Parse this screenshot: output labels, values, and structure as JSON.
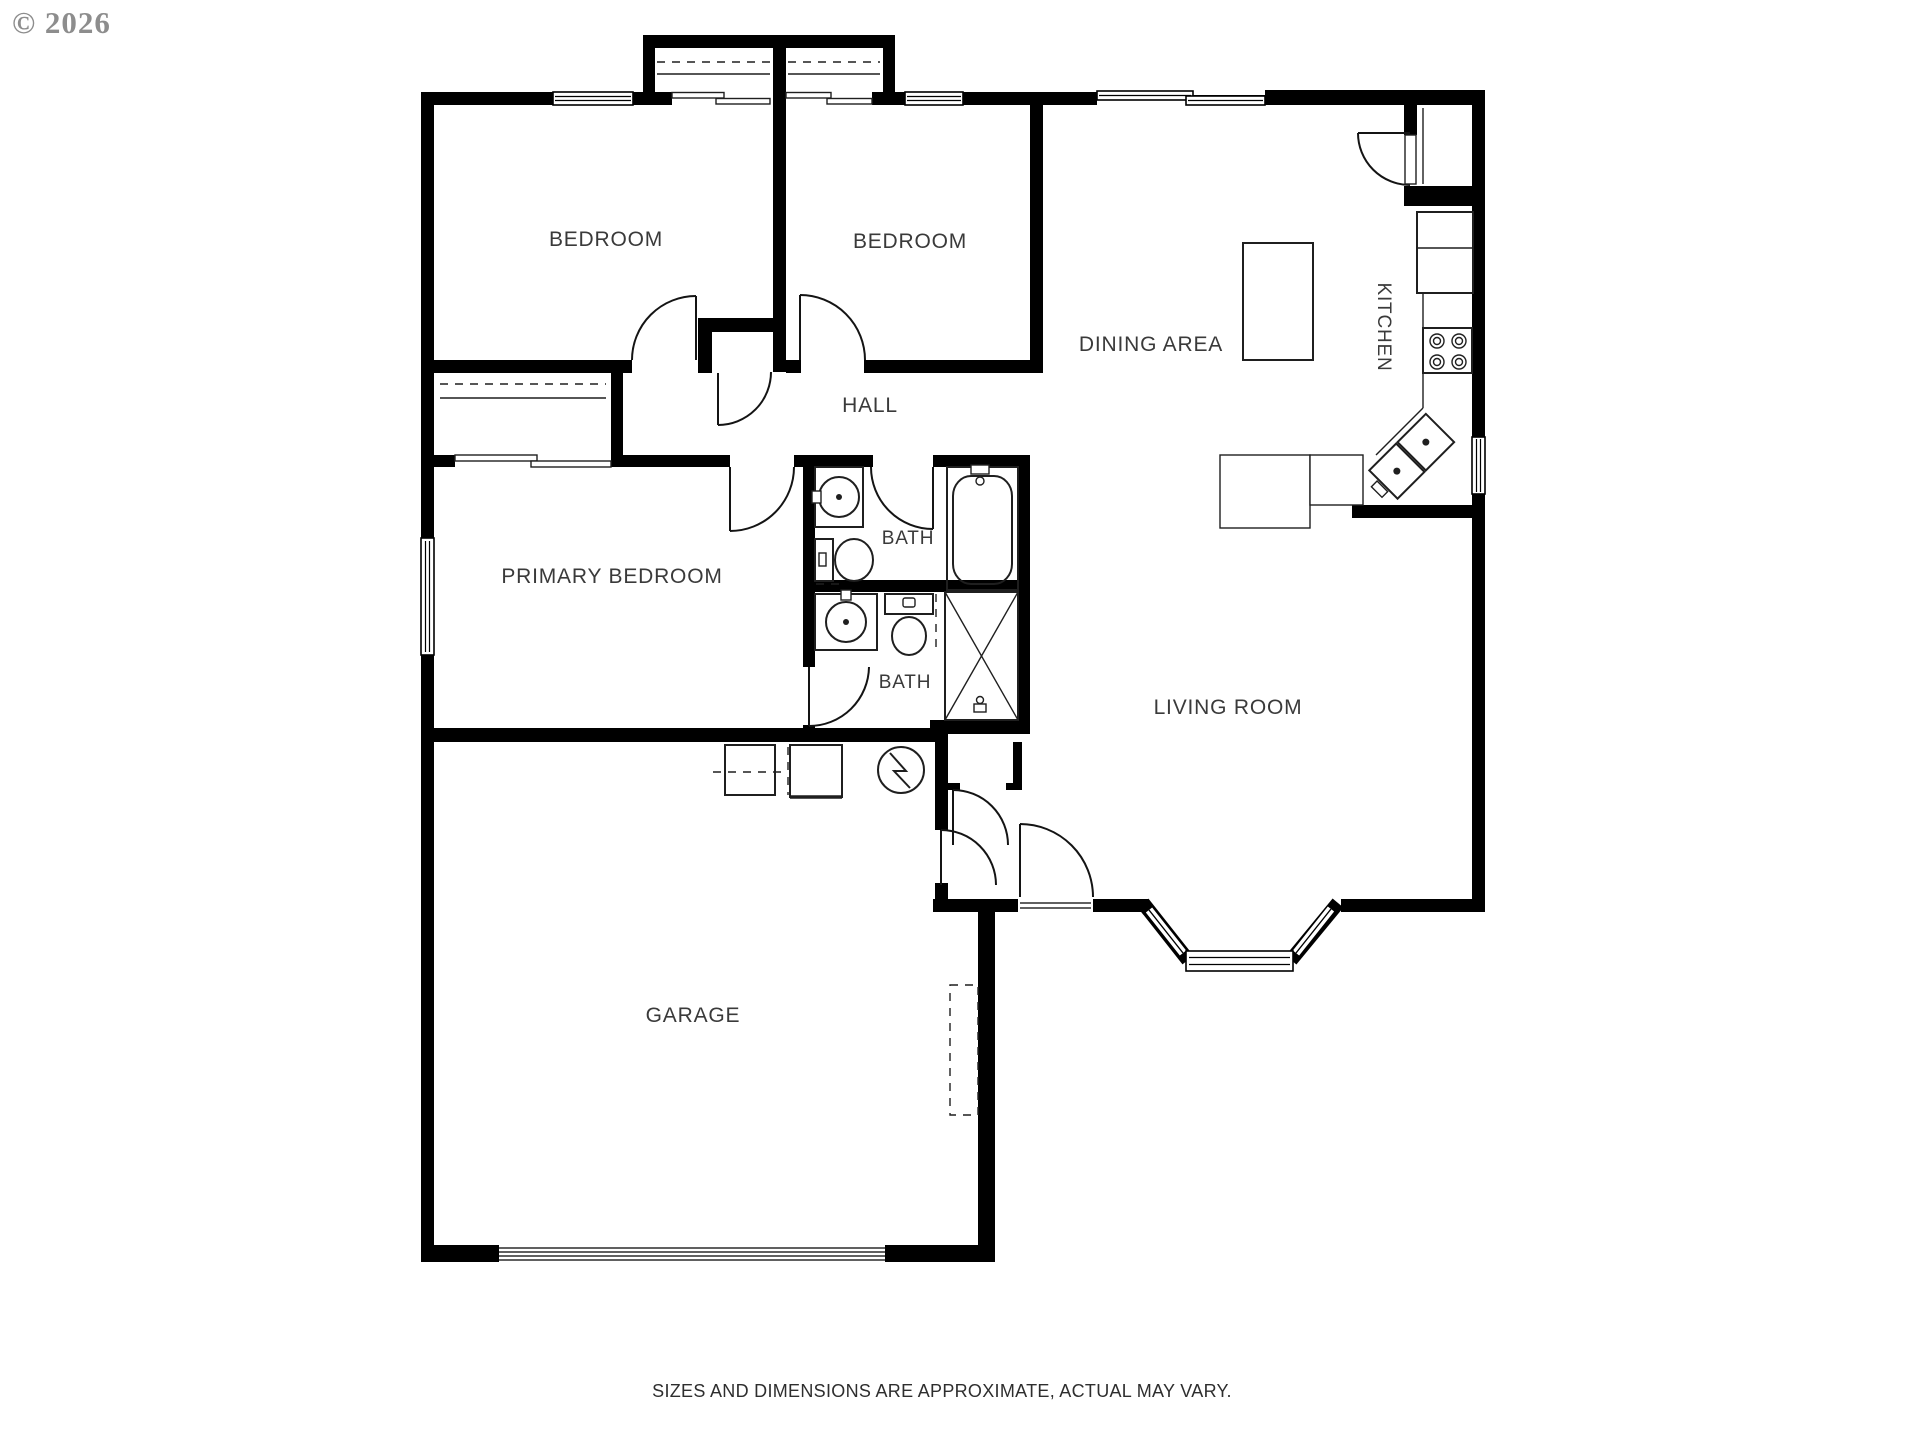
{
  "meta": {
    "copyright": "© 2026",
    "disclaimer": "SIZES AND DIMENSIONS ARE APPROXIMATE, ACTUAL MAY VARY."
  },
  "colors": {
    "wall": "#000000",
    "background": "#ffffff",
    "label": "#3a3a3a",
    "fixture_line": "#1f1f1f",
    "copyright": "#8d8d8d"
  },
  "rooms": [
    {
      "id": "bedroom-1",
      "label": "BEDROOM"
    },
    {
      "id": "bedroom-2",
      "label": "BEDROOM"
    },
    {
      "id": "dining-area",
      "label": "DINING AREA"
    },
    {
      "id": "kitchen",
      "label": "KITCHEN",
      "label_rotation_deg": 90
    },
    {
      "id": "hall",
      "label": "HALL"
    },
    {
      "id": "primary-bedroom",
      "label": "PRIMARY BEDROOM"
    },
    {
      "id": "bath-hall",
      "label": "BATH"
    },
    {
      "id": "bath-primary",
      "label": "BATH"
    },
    {
      "id": "living-room",
      "label": "LIVING ROOM"
    },
    {
      "id": "garage",
      "label": "GARAGE"
    }
  ],
  "fixtures": [
    "stove-icon",
    "corner-sink-icon",
    "refrigerator-icon",
    "pantry-icon",
    "kitchen-island-icon",
    "bathtub-icon",
    "toilet-icon",
    "vanity-sink-icon",
    "shower-icon",
    "washer-icon",
    "dryer-icon",
    "water-heater-icon",
    "bay-window-icon",
    "garage-door-icon",
    "window-icon",
    "door-swing-icon",
    "closet-rod-icon",
    "sliding-door-icon"
  ]
}
